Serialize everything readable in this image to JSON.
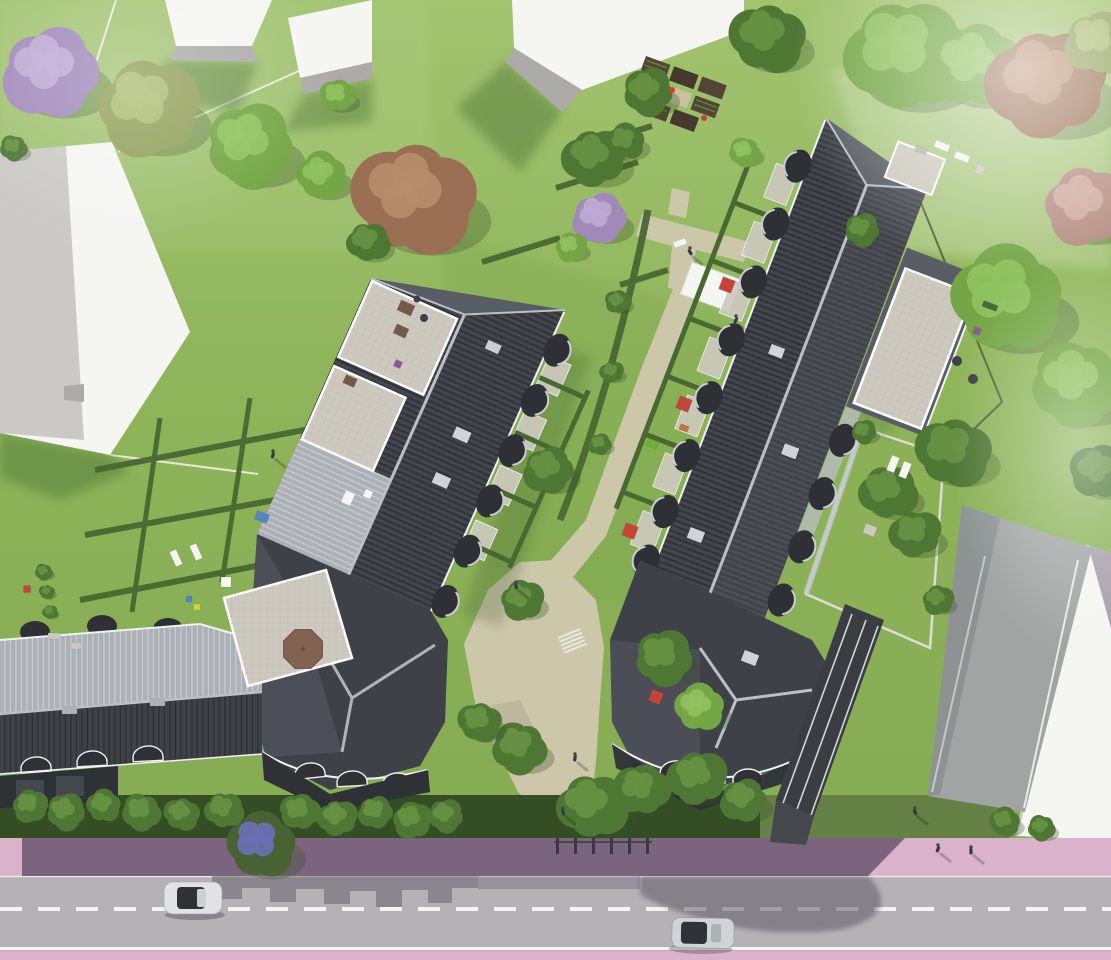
{
  "meta": {
    "type": "architectural-aerial-rendering",
    "subject": "bird's-eye rendering of a residential housing development with two large dark-roofed apartment buildings, hedged private gardens, beige footpaths, lawns with trees, and a street with pink sidewalks at the bottom",
    "width": 1111,
    "height": 960
  },
  "palette": {
    "lawn": "#8cb454",
    "lawn-light": "#a9c97c",
    "lawn-pale": "#bdd49a",
    "lawn-dark": "#6d9a3e",
    "lawn-shadow": "#4c7230",
    "hedge": "#3f6128",
    "hedge-dark": "#2b4419",
    "roof-dark": "#34373e",
    "roof-dark-line": "#23252b",
    "roof-mid": "#50545c",
    "roof-light": "#a9adb4",
    "roof-light-line": "#c8ccd1",
    "ridge": "#b9bdc3",
    "eave-white": "#f0f1f2",
    "deck": "#cbc7bc",
    "deck-line": "#b3afa4",
    "white": "#f5f5f2",
    "gray-bld": "#c9c7c3",
    "bld-side": "#a9a7a5",
    "path": "#cbc4a6",
    "path-shade": "#aaa489",
    "soil": "#4a3b2a",
    "soil-dark": "#3a2f21",
    "sand": "#cbbd9e",
    "street": "#b0aeb2",
    "street-shadow": "#57525c",
    "sidewalk-pink": "#d8aec8",
    "sidewalk-shadow": "#5e4a66",
    "lane-line": "#f4f4f4",
    "car-silver": "#dfe1e2",
    "car-silver2": "#cfd2d4",
    "car-glass": "#26282d",
    "facade-dark": "#23262b",
    "railing": "#e2e6e8",
    "driveway": "#9ba09f",
    "ramp-dark": "#303338",
    "umbrella-red": "#c23a2c",
    "umbrella-brown": "#7c5b49",
    "furn-brown": "#6b5140",
    "furn-orange": "#c06b3a",
    "toy-green": "#63ad2e",
    "accent-violet": "#8a4f9e",
    "accent-blue": "#4a7fc1",
    "accent-yellow": "#d3d22f",
    "tree-shadow": "#2f4a1e",
    "person": "#2b3036"
  },
  "tree_variants": {
    "green": [
      "#6da23c",
      "#8cbf58"
    ],
    "dark": [
      "#45702a",
      "#5f8c38"
    ],
    "olive": [
      "#8c9a50",
      "#aab86a"
    ],
    "lilac": [
      "#9c83b6",
      "#bca6d2"
    ],
    "red": [
      "#95684a",
      "#b28766"
    ],
    "pink": [
      "#b3887c",
      "#cfa89b"
    ],
    "street": [
      "#3f5a2a",
      "#6468b0"
    ]
  },
  "trees": [
    [
      52,
      72,
      50,
      "lilac"
    ],
    [
      148,
      108,
      52,
      "olive"
    ],
    [
      250,
      146,
      45,
      "green"
    ],
    [
      322,
      176,
      26,
      "green"
    ],
    [
      14,
      148,
      14,
      "dark"
    ],
    [
      415,
      198,
      62,
      "red"
    ],
    [
      368,
      242,
      22,
      "dark"
    ],
    [
      338,
      96,
      18,
      "green"
    ],
    [
      595,
      158,
      32,
      "dark"
    ],
    [
      600,
      218,
      28,
      "lilac"
    ],
    [
      571,
      247,
      16,
      "green"
    ],
    [
      648,
      92,
      26,
      "dark"
    ],
    [
      626,
      142,
      20,
      "dark"
    ],
    [
      745,
      152,
      16,
      "green"
    ],
    [
      768,
      38,
      38,
      "dark"
    ],
    [
      905,
      55,
      62,
      "green"
    ],
    [
      975,
      66,
      46,
      "green"
    ],
    [
      1048,
      84,
      60,
      "red"
    ],
    [
      1098,
      42,
      34,
      "olive"
    ],
    [
      1085,
      206,
      42,
      "pink"
    ],
    [
      862,
      230,
      18,
      "dark"
    ],
    [
      1008,
      300,
      58,
      "green"
    ],
    [
      1078,
      384,
      46,
      "green"
    ],
    [
      954,
      452,
      38,
      "dark"
    ],
    [
      888,
      492,
      30,
      "dark"
    ],
    [
      1100,
      472,
      30,
      "dark"
    ],
    [
      916,
      534,
      26,
      "dark"
    ],
    [
      549,
      470,
      26,
      "dark"
    ],
    [
      522,
      600,
      22,
      "dark"
    ],
    [
      664,
      658,
      30,
      "dark"
    ],
    [
      700,
      708,
      26,
      "green"
    ],
    [
      520,
      748,
      28,
      "dark"
    ],
    [
      480,
      722,
      22,
      "dark"
    ],
    [
      592,
      806,
      36,
      "dark"
    ],
    [
      642,
      790,
      28,
      "dark"
    ],
    [
      698,
      778,
      30,
      "dark"
    ],
    [
      744,
      800,
      24,
      "dark"
    ],
    [
      30,
      806,
      18,
      "dark"
    ],
    [
      66,
      812,
      20,
      "dark"
    ],
    [
      104,
      806,
      18,
      "dark"
    ],
    [
      142,
      812,
      20,
      "dark"
    ],
    [
      182,
      814,
      18,
      "dark"
    ],
    [
      224,
      810,
      20,
      "dark"
    ],
    [
      300,
      812,
      20,
      "dark"
    ],
    [
      338,
      818,
      20,
      "dark"
    ],
    [
      376,
      812,
      18,
      "dark"
    ],
    [
      412,
      820,
      20,
      "dark"
    ],
    [
      446,
      816,
      18,
      "dark"
    ],
    [
      262,
      846,
      36,
      "street"
    ],
    [
      44,
      572,
      9,
      "dark"
    ],
    [
      47,
      592,
      8,
      "dark"
    ],
    [
      50,
      612,
      8,
      "dark"
    ],
    [
      618,
      302,
      13,
      "dark"
    ],
    [
      612,
      372,
      12,
      "dark"
    ],
    [
      600,
      444,
      12,
      "dark"
    ],
    [
      938,
      600,
      16,
      "dark"
    ],
    [
      864,
      432,
      13,
      "dark"
    ],
    [
      1005,
      822,
      16,
      "dark"
    ],
    [
      1042,
      828,
      14,
      "dark"
    ]
  ],
  "people": [
    [
      690,
      252
    ],
    [
      575,
      758
    ],
    [
      563,
      812
    ],
    [
      938,
      849
    ],
    [
      971,
      851
    ],
    [
      915,
      812
    ],
    [
      273,
      455
    ],
    [
      516,
      586
    ],
    [
      736,
      320
    ]
  ],
  "props": [
    {
      "t": "rect",
      "x": 406,
      "y": 308,
      "w": 15,
      "h": 11,
      "rot": 24,
      "fill": "furn-brown"
    },
    {
      "t": "rect",
      "x": 401,
      "y": 331,
      "w": 13,
      "h": 10,
      "rot": 24,
      "fill": "furn-brown"
    },
    {
      "t": "circle",
      "x": 424,
      "y": 318,
      "r": 4,
      "fill": "roof-dark"
    },
    {
      "t": "circle",
      "x": 417,
      "y": 299,
      "r": 3.5,
      "fill": "roof-dark"
    },
    {
      "t": "rect",
      "x": 350,
      "y": 381,
      "w": 12,
      "h": 9,
      "rot": 24,
      "fill": "furn-brown"
    },
    {
      "t": "rect",
      "x": 398,
      "y": 364,
      "w": 7,
      "h": 7,
      "rot": 24,
      "fill": "accent-violet"
    },
    {
      "t": "circle",
      "x": 957,
      "y": 361,
      "r": 5,
      "fill": "roof-dark"
    },
    {
      "t": "circle",
      "x": 973,
      "y": 379,
      "r": 5,
      "fill": "roof-dark"
    },
    {
      "t": "rect",
      "x": 977,
      "y": 331,
      "w": 7,
      "h": 7,
      "rot": 21,
      "fill": "accent-violet"
    },
    {
      "t": "rect",
      "x": 990,
      "y": 306,
      "w": 15,
      "h": 6,
      "rot": 21,
      "fill": "hedge"
    },
    {
      "t": "rect",
      "x": 921,
      "y": 150,
      "w": 12,
      "h": 6,
      "rot": 21,
      "fill": "deck-line"
    },
    {
      "t": "rect",
      "x": 727,
      "y": 285,
      "w": 13,
      "h": 13,
      "rot": 21,
      "fill": "umbrella-red"
    },
    {
      "t": "rect",
      "x": 684,
      "y": 404,
      "w": 13,
      "h": 13,
      "rot": 21,
      "fill": "umbrella-red"
    },
    {
      "t": "rect",
      "x": 630,
      "y": 531,
      "w": 13,
      "h": 13,
      "rot": 21,
      "fill": "umbrella-red"
    },
    {
      "t": "rect",
      "x": 656,
      "y": 697,
      "w": 12,
      "h": 12,
      "rot": 21,
      "fill": "umbrella-red"
    },
    {
      "t": "rect",
      "x": 684,
      "y": 428,
      "w": 9,
      "h": 6,
      "rot": 21,
      "fill": "furn-orange"
    },
    {
      "t": "rect",
      "x": 652,
      "y": 444,
      "w": 12,
      "h": 7,
      "rot": 21,
      "fill": "toy-green"
    },
    {
      "t": "rect",
      "x": 893,
      "y": 464,
      "w": 8,
      "h": 16,
      "rot": 21,
      "fill": "white"
    },
    {
      "t": "rect",
      "x": 905,
      "y": 470,
      "w": 8,
      "h": 16,
      "rot": 21,
      "fill": "white"
    },
    {
      "t": "rect",
      "x": 870,
      "y": 530,
      "w": 12,
      "h": 10,
      "rot": 21,
      "fill": "deck"
    },
    {
      "t": "rect",
      "x": 176,
      "y": 558,
      "w": 16,
      "h": 7,
      "rot": 66,
      "fill": "white"
    },
    {
      "t": "rect",
      "x": 196,
      "y": 552,
      "w": 16,
      "h": 7,
      "rot": 66,
      "fill": "white"
    },
    {
      "t": "rect",
      "x": 226,
      "y": 582,
      "w": 10,
      "h": 10,
      "rot": 0,
      "fill": "white"
    },
    {
      "t": "rect",
      "x": 262,
      "y": 517,
      "w": 13,
      "h": 9,
      "rot": 20,
      "fill": "accent-blue"
    },
    {
      "t": "rect",
      "x": 189,
      "y": 599,
      "w": 6,
      "h": 6,
      "rot": 0,
      "fill": "accent-blue"
    },
    {
      "t": "rect",
      "x": 197,
      "y": 607,
      "w": 6,
      "h": 6,
      "rot": 0,
      "fill": "accent-yellow"
    },
    {
      "t": "rect",
      "x": 348,
      "y": 498,
      "w": 10,
      "h": 13,
      "rot": 24,
      "fill": "white"
    },
    {
      "t": "rect",
      "x": 368,
      "y": 494,
      "w": 8,
      "h": 8,
      "rot": 24,
      "fill": "white"
    },
    {
      "t": "circle",
      "x": 310,
      "y": 647,
      "r": 4,
      "fill": "roof-dark"
    },
    {
      "t": "rect",
      "x": 54,
      "y": 636,
      "w": 12,
      "h": 6,
      "rot": 0,
      "fill": "deck"
    },
    {
      "t": "rect",
      "x": 76,
      "y": 646,
      "w": 10,
      "h": 6,
      "rot": 0,
      "fill": "deck"
    },
    {
      "t": "rect",
      "x": 27,
      "y": 589,
      "w": 7,
      "h": 7,
      "rot": 0,
      "fill": "umbrella-red"
    },
    {
      "t": "rect",
      "x": 942,
      "y": 146,
      "w": 15,
      "h": 7,
      "rot": 21,
      "fill": "white"
    },
    {
      "t": "rect",
      "x": 962,
      "y": 157,
      "w": 15,
      "h": 7,
      "rot": 21,
      "fill": "white"
    },
    {
      "t": "rect",
      "x": 980,
      "y": 170,
      "w": 9,
      "h": 9,
      "rot": 21,
      "fill": "deck"
    },
    {
      "t": "rect",
      "x": 680,
      "y": 243,
      "w": 13,
      "h": 6,
      "rot": -20,
      "fill": "white"
    },
    {
      "t": "circle",
      "x": 672,
      "y": 90,
      "r": 3,
      "fill": "umbrella-red"
    },
    {
      "t": "circle",
      "x": 704,
      "y": 118,
      "r": 3,
      "fill": "umbrella-red"
    },
    {
      "t": "oct",
      "x": 303,
      "y": 649,
      "r": 21,
      "fill": "umbrella-brown"
    }
  ],
  "scene": {
    "main_buildings": 2,
    "street_wing_buildings": 1,
    "background_white_buildings": 5,
    "cars": [
      {
        "color": "white-silver",
        "lane": "upper",
        "heading": "west"
      },
      {
        "color": "silver",
        "lane": "lower",
        "heading": "east"
      }
    ],
    "street": {
      "sidewalk_color": "pink",
      "road_color": "gray",
      "center_line": "white-dashed",
      "edge_line": "white-solid"
    },
    "roof_terraces": 5,
    "red_patio_umbrellas": 4,
    "brown_octagonal_umbrella": 1,
    "allotment_plots": 8,
    "hedged_private_gardens": true,
    "underground_garage_ramp": true,
    "pedestrians": 9
  }
}
